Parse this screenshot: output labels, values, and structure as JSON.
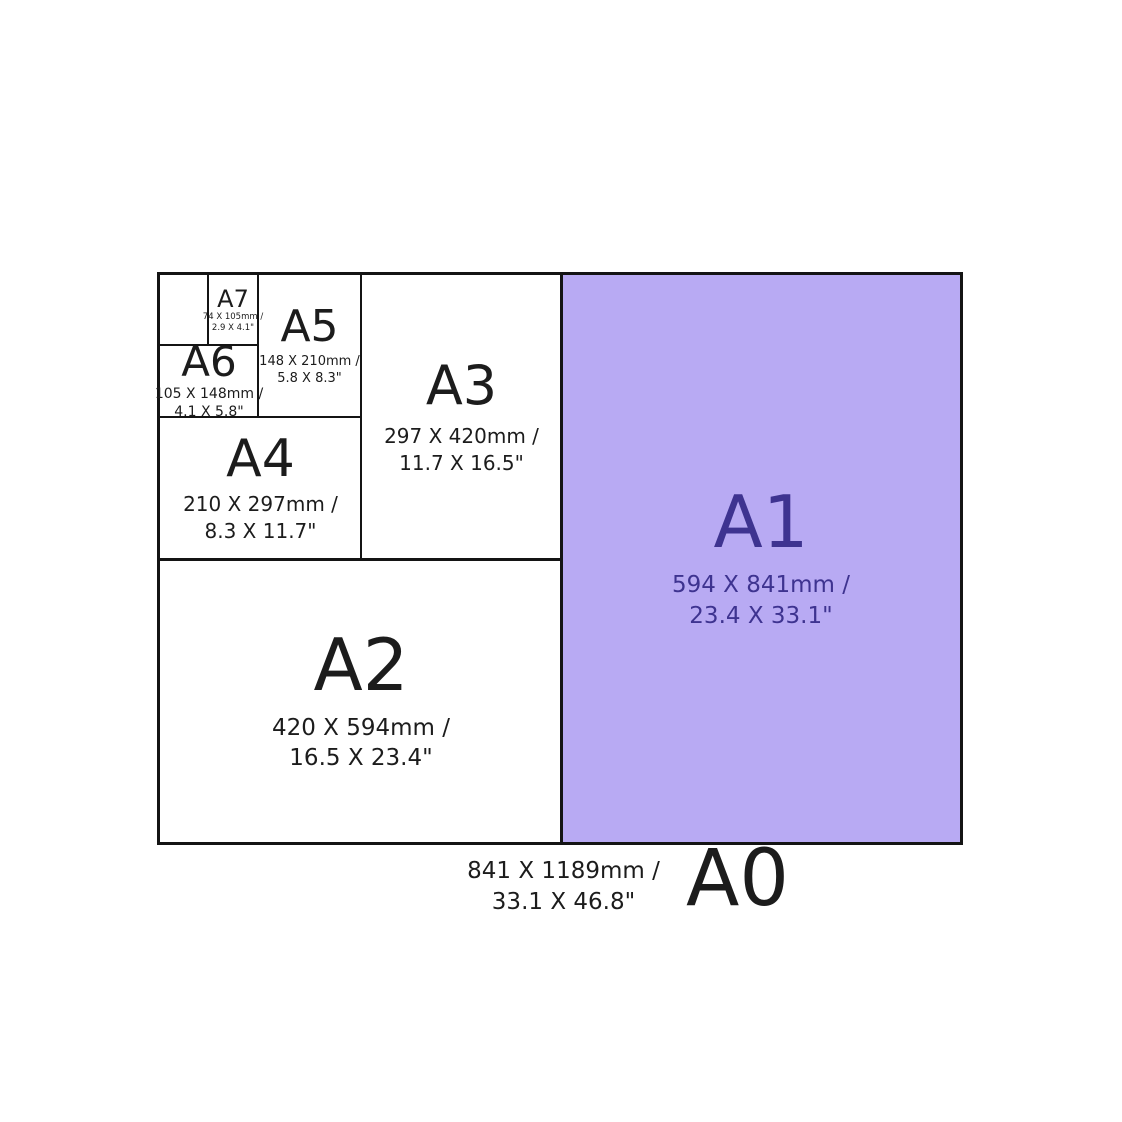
{
  "title": "A-series paper sizes comparison diagram",
  "colors": {
    "background": "#ffffff",
    "line": "#141414",
    "text": "#1c1c1c",
    "a1_fill": "#b8aaf3",
    "a1_text": "#3e3390"
  },
  "panels": {
    "a0": {
      "label": "A0",
      "mm": "841 X 1189mm /",
      "inches": "33.1 X 46.8\""
    },
    "a1": {
      "label": "A1",
      "mm": "594 X 841mm /",
      "inches": "23.4 X 33.1\""
    },
    "a2": {
      "label": "A2",
      "mm": "420 X 594mm /",
      "inches": "16.5 X 23.4\""
    },
    "a3": {
      "label": "A3",
      "mm": "297 X 420mm /",
      "inches": "11.7 X 16.5\""
    },
    "a4": {
      "label": "A4",
      "mm": "210 X 297mm /",
      "inches": "8.3 X 11.7\""
    },
    "a5": {
      "label": "A5",
      "mm": "148 X 210mm /",
      "inches": "5.8 X 8.3\""
    },
    "a6": {
      "label": "A6",
      "mm": "105 X 148mm /",
      "inches": "4.1 X 5.8\""
    },
    "a7": {
      "label": "A7",
      "mm": "74 X 105mm /",
      "inches": "2.9 X 4.1\""
    }
  }
}
